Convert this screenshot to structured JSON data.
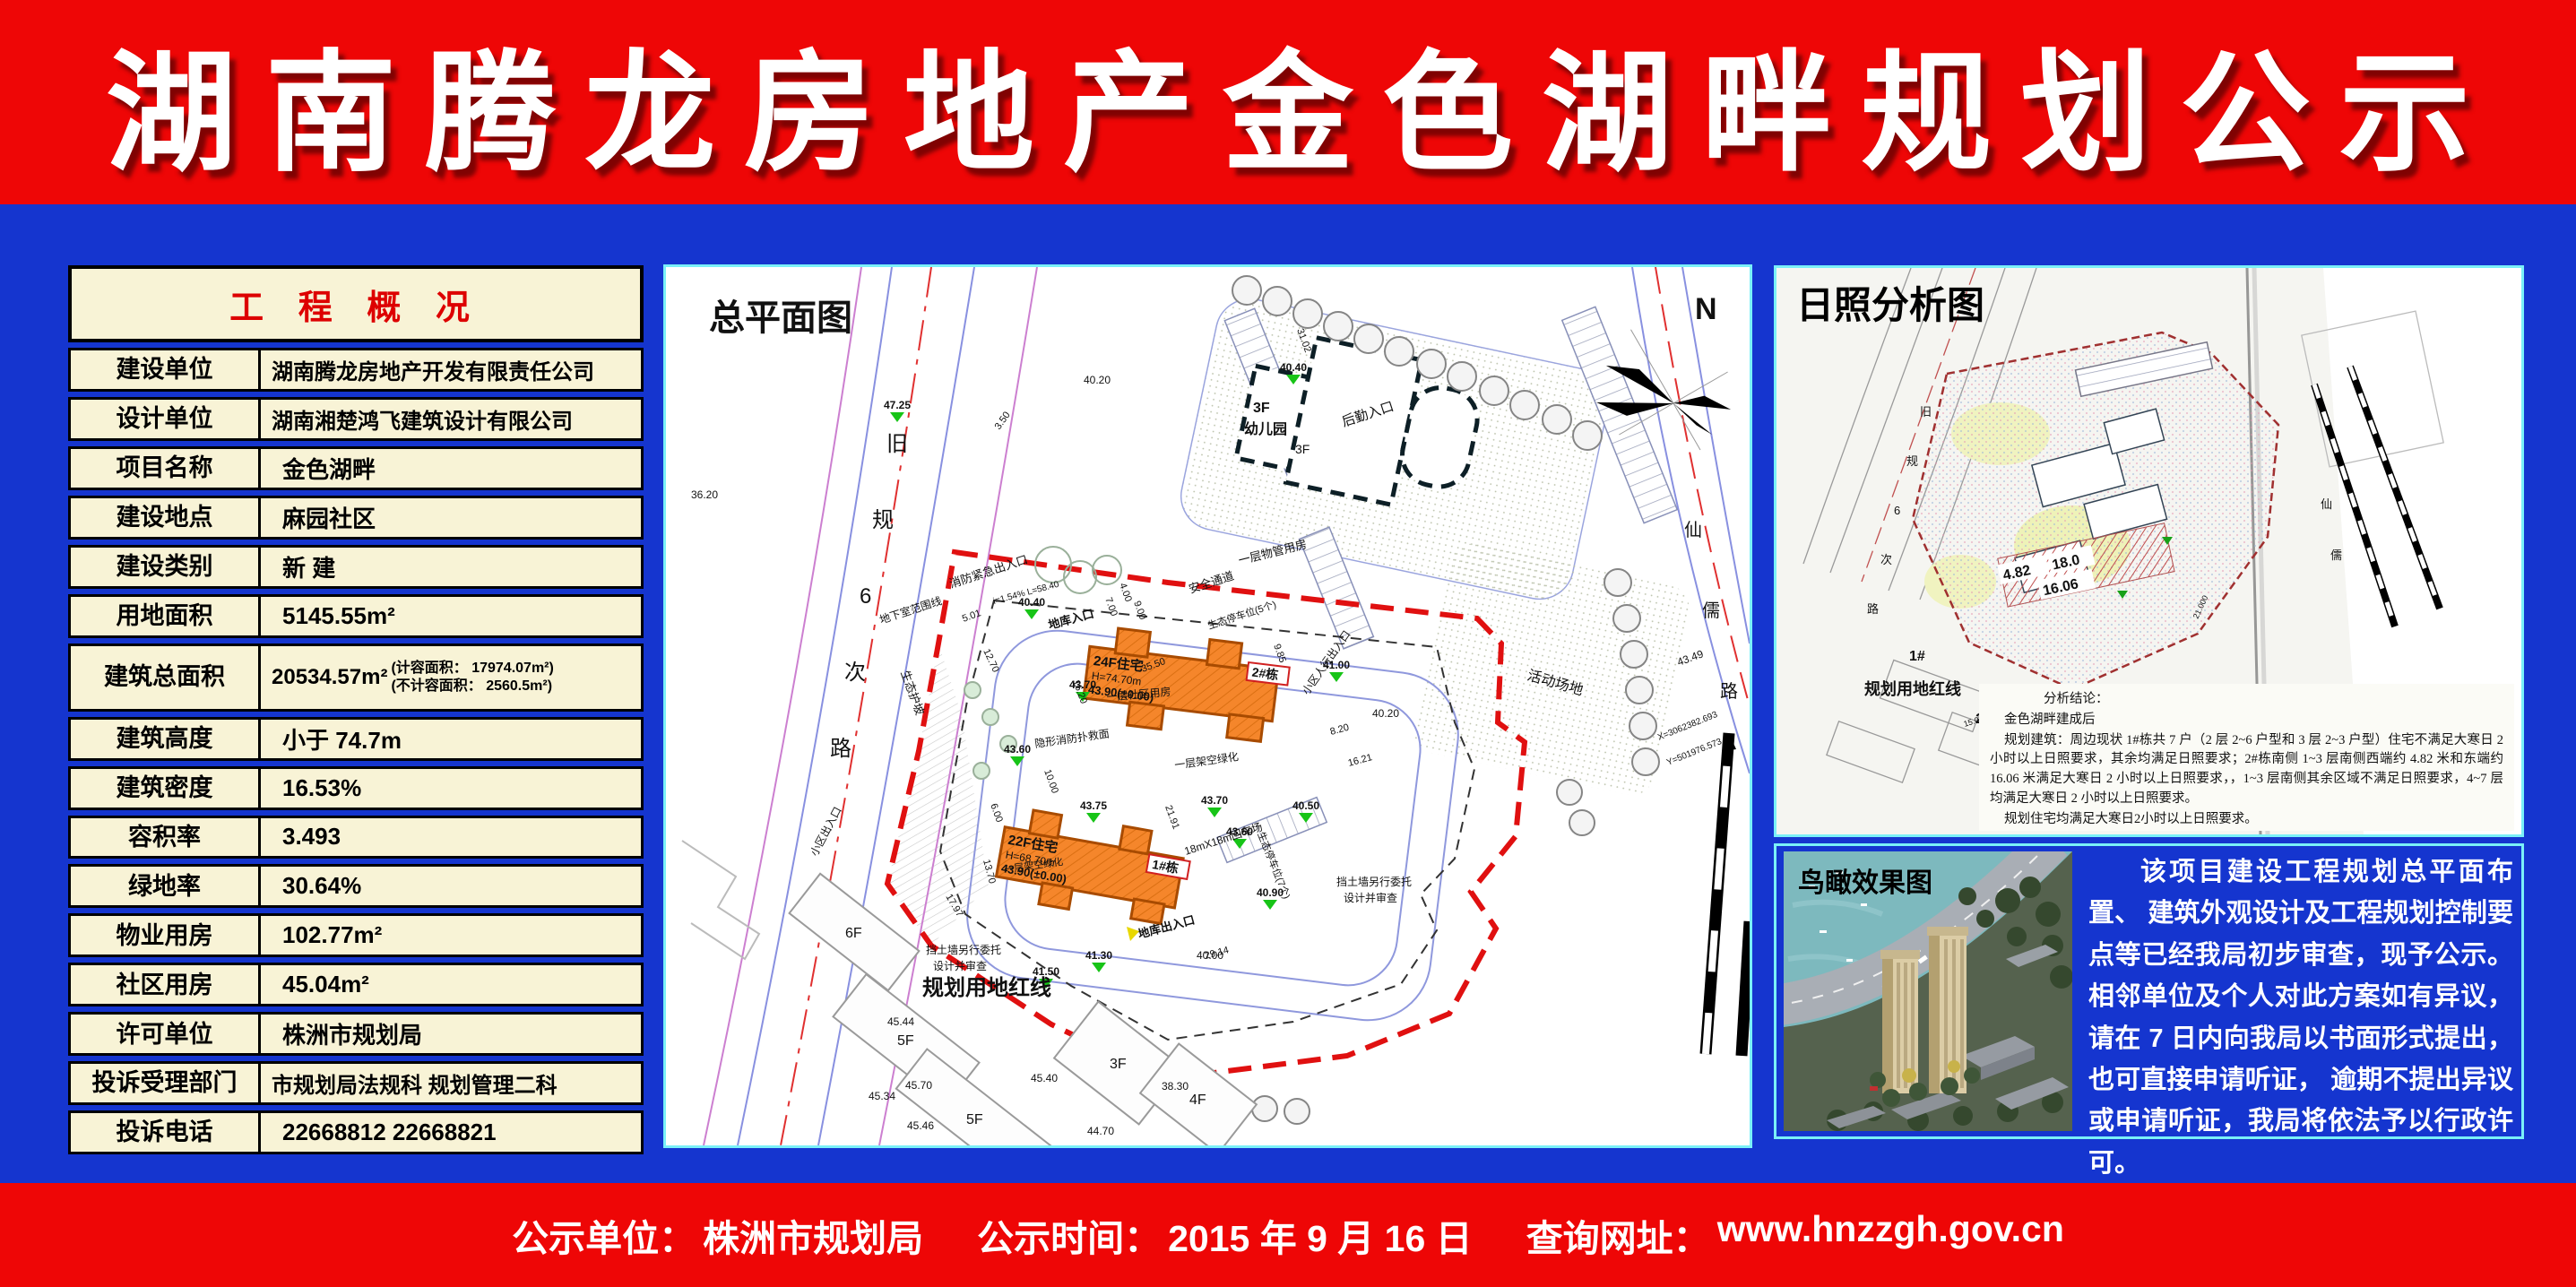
{
  "banner": {
    "title": "湖南腾龙房地产金色湖畔规划公示"
  },
  "overview_table": {
    "title": "工 程 概 况",
    "rows": [
      {
        "label": "建设单位",
        "value": "湖南腾龙房地产开发有限责任公司"
      },
      {
        "label": "设计单位",
        "value": "湖南湘楚鸿飞建筑设计有限公司"
      },
      {
        "label": "项目名称",
        "value": "金色湖畔"
      },
      {
        "label": "建设地点",
        "value": "麻园社区"
      },
      {
        "label": "建设类别",
        "value": "新 建"
      },
      {
        "label": "用地面积",
        "value": "5145.55m²"
      },
      {
        "label": "建筑总面积",
        "value": "20534.57m²",
        "note1": "(计容面积： 17974.07m²)",
        "note2": "(不计容面积： 2560.5m²)"
      },
      {
        "label": "建筑高度",
        "value": "小于 74.7m"
      },
      {
        "label": "建筑密度",
        "value": "16.53%"
      },
      {
        "label": "容积率",
        "value": "3.493"
      },
      {
        "label": "绿地率",
        "value": "30.64%"
      },
      {
        "label": "物业用房",
        "value": "102.77m²"
      },
      {
        "label": "社区用房",
        "value": "45.04m²"
      },
      {
        "label": "许可单位",
        "value": "株洲市规划局"
      },
      {
        "label": "投诉受理部门",
        "value": "市规划局法规科 规划管理二科"
      },
      {
        "label": "投诉电话",
        "value": "22668812   22668821"
      }
    ]
  },
  "site_plan": {
    "title": "总平面图",
    "north": "N",
    "road_left_chars": [
      "旧",
      "规",
      "6",
      "次",
      "路"
    ],
    "road_right_chars": [
      "仙",
      "儒",
      "路"
    ],
    "buildings": [
      {
        "tag": "2#栋",
        "floors": "24F住宅",
        "height": "H=74.70m",
        "level": "43.90(±0.00)"
      },
      {
        "tag": "1#栋",
        "floors": "22F住宅",
        "height": "H=68.70m",
        "level": "43.90(±0.00)"
      }
    ],
    "labels": {
      "kg_floor": "3F",
      "kg_name": "幼儿园",
      "kg_floor2": "3F",
      "rear_entrance": "后勤入口",
      "pm_room": "一层物管用房",
      "activity": "活动场地",
      "safety": "安全通道",
      "eco_parking5": "生态停车位(5个)",
      "eco_parking7": "生态停车位(7个)",
      "fire_exit": "消防紧急出入口",
      "basement_line": "地下室范围线",
      "garage_in": "地库入口",
      "garage_out": "地库出入口",
      "road_note": "i=1.54%  L=58.40",
      "ped_entrance": "小区人行出入口",
      "community_room": "一层社区用房",
      "fire_surface": "隐形消防扑救面",
      "stilt_green": "一层架空绿化",
      "stilt_green2": "一层架空绿化",
      "turnaround": "18mX18m回车场",
      "retaining_l1": "挡土墙另行委托",
      "retaining_l2": "设计并审查",
      "red_line": "规划用地红线",
      "district_entrance": "小区出入口",
      "eco_slope": "生态护坡",
      "coord_x": "X=3062382.693",
      "coord_y": "Y=501976.573"
    },
    "elev": [
      "47.25",
      "40.40",
      "41.00",
      "43.70",
      "43.60",
      "43.75",
      "43.70",
      "43.60",
      "40.50",
      "40.90",
      "41.50",
      "41.30",
      "40.40"
    ],
    "gray": [
      "36.20",
      "40.20",
      "40.20",
      "45.44",
      "45.70",
      "45.34",
      "45.46",
      "45.40",
      "44.70",
      "38.30",
      "43.49",
      "40.00"
    ],
    "dims": [
      "3.50",
      "5.01",
      "12.70",
      "7.00",
      "9.00",
      "4.00",
      "9.85",
      "31.02",
      "16.20",
      "35.50",
      "10.00",
      "6.00",
      "21.91",
      "13.70",
      "8.20",
      "16.21",
      "29.14",
      "17.97"
    ],
    "neighbors": [
      "6F",
      "5F",
      "5F",
      "3F",
      "4F"
    ]
  },
  "sun_panel": {
    "title": "日照分析图",
    "red_line_label": "规划用地红线",
    "tags": [
      "1#",
      "2#",
      "3#"
    ],
    "numbers": [
      "4.82",
      "18.0",
      "16.06"
    ],
    "road_chars": [
      "旧",
      "规",
      "6",
      "次",
      "路"
    ],
    "road_right_chars": [
      "仙",
      "儒"
    ],
    "dims": [
      "15.000(45.700)",
      "15.000(45.400)",
      "21.000"
    ],
    "conclusion_title": "分析结论：",
    "conclusion_sub": "金色湖畔建成后",
    "conclusion_body": "规划建筑：周边现状 1#栋共 7 户（2 层 2~6 户型和 3 层 2~3 户型）住宅不满足大寒日 2 小时以上日照要求，其余均满足日照要求；2#栋南侧 1~3 层南侧西端约 4.82 米和东端约 16.06 米满足大寒日 2 小时以上日照要求，，1~3 层南侧其余区域不满足日照要求，4~7 层均满足大寒日 2 小时以上日照要求。",
    "conclusion_last": "规划住宅均满足大寒日2小时以上日照要求。"
  },
  "birdseye": {
    "label": "鸟瞰效果图"
  },
  "notice": {
    "body": "该项目建设工程规划总平面布置、 建筑外观设计及工程规划控制要点等已经我局初步审查，现予公示。 相邻单位及个人对此方案如有异议，请在 7 日内向我局以书面形式提出，也可直接申请听证， 逾期不提出异议或申请听证，我局将依法予以行政许可。",
    "signature": "株洲市规划局",
    "date": "2015 年 9 月 16 日"
  },
  "footer": {
    "parts": [
      {
        "label": "公示单位：",
        "value": "株洲市规划局"
      },
      {
        "label": "公示时间：",
        "value": "2015 年 9 月 16 日"
      },
      {
        "label": "查询网址：",
        "value": "www.hnzzgh.gov.cn"
      }
    ]
  }
}
